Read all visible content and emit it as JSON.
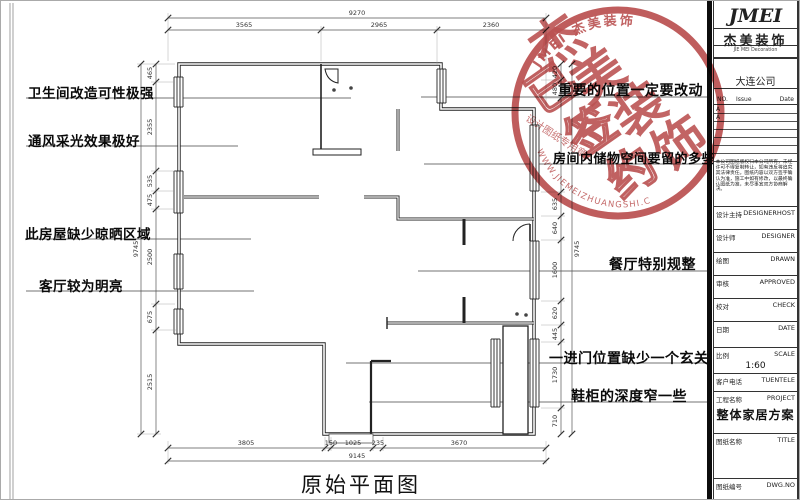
{
  "sheet": {
    "plan_title": "原始平面图"
  },
  "annotations": {
    "left": [
      "卫生间改造可性极强",
      "通风采光效果极好",
      "此房屋缺少晾晒区域",
      "客厅较为明亮"
    ],
    "right": [
      "重要的位置一定要改动",
      "房间内储物空间要留的多些",
      "餐厅特别规整",
      "一进门位置缺少一个玄关",
      "鞋柜的深度窄一些"
    ]
  },
  "dimensions": {
    "top": {
      "overall": "9270",
      "seg1": "3565",
      "seg2": "2965",
      "seg3": "2360"
    },
    "bottom": {
      "overall": "9145",
      "seg1": "3805",
      "seg2": "150",
      "seg3": "1025",
      "seg4": "235",
      "seg5": "3670"
    },
    "left": {
      "overall": "9745",
      "seg1": "465",
      "seg2": "2355",
      "seg3": "535",
      "seg4": "475",
      "seg5": "2500",
      "seg6": "675",
      "seg7": "2515"
    },
    "right": {
      "overall": "9745",
      "seg1": "420",
      "seg2": "480",
      "seg3": "635",
      "seg4": "640",
      "seg5": "1600",
      "seg6": "620",
      "seg7": "445",
      "seg8": "1730",
      "seg9": "710"
    }
  },
  "stamp": {
    "arc_top": "JMEI 杰美装饰",
    "main_chars": [
      "杰",
      "美",
      "装",
      "饰"
    ],
    "overlay_chars": [
      "已",
      "签",
      "约"
    ],
    "side_text": "设计图纸专用章",
    "arc_bottom": "WWW.JIEMEIZHUANGSHI.COM",
    "color": "#b23c3c"
  },
  "titleblock": {
    "logo": "JMEI",
    "company_cn": "杰美装饰",
    "company_en": "JIE MEI Decoration",
    "branch": "大连公司",
    "rev": {
      "no": "NO.",
      "issue": "Issue",
      "date": "Date",
      "row1": "A",
      "row2": "A"
    },
    "notes": "本公司图纸版权归本公司所有，未经许可不得复制转让，如有违反将追究其法律责任。图纸内容以双方签字确认为准，施工中如有修改，以最终确认图纸为准，未尽事宜双方协商解决。",
    "rows": [
      {
        "cn": "设计主持",
        "en": "DESIGNERHOST",
        "value": ""
      },
      {
        "cn": "设计师",
        "en": "DESIGNER",
        "value": ""
      },
      {
        "cn": "绘图",
        "en": "DRAWN",
        "value": ""
      },
      {
        "cn": "审核",
        "en": "APPROVED",
        "value": ""
      },
      {
        "cn": "校对",
        "en": "CHECK",
        "value": ""
      },
      {
        "cn": "日期",
        "en": "DATE",
        "value": ""
      },
      {
        "cn": "比例",
        "en": "SCALE",
        "value": "1:60"
      },
      {
        "cn": "客户电话",
        "en": "TUENTELE",
        "value": ""
      },
      {
        "cn": "工程名称",
        "en": "PROJECT",
        "value": "整体家居方案"
      },
      {
        "cn": "图纸名称",
        "en": "TITLE",
        "value": ""
      },
      {
        "cn": "图纸编号",
        "en": "DWG.NO",
        "value": ""
      }
    ]
  }
}
